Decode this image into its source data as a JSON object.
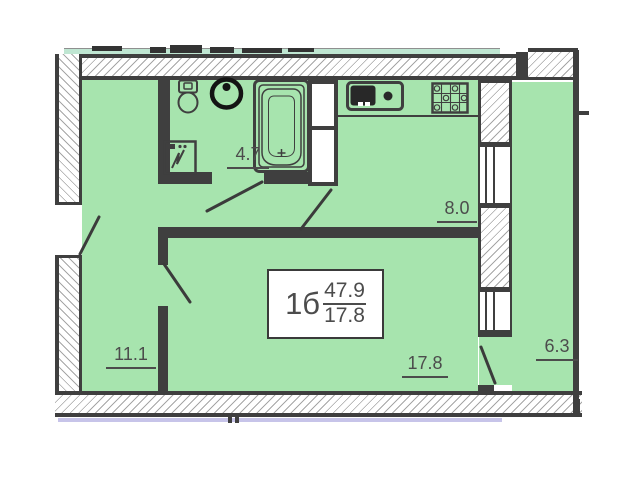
{
  "plan": {
    "info_box": {
      "type_label": "1б",
      "total_area": "47.9",
      "living_area": "17.8"
    },
    "rooms": [
      {
        "name": "bathroom",
        "area": "4.7"
      },
      {
        "name": "kitchen",
        "area": "8.0"
      },
      {
        "name": "hallway",
        "area": "11.1"
      },
      {
        "name": "living-room",
        "area": "17.8"
      },
      {
        "name": "balcony",
        "area": "6.3"
      }
    ],
    "colors": {
      "floor": "#a7e4ae",
      "strip": "#bfe6d2",
      "wall": "#3f3f3f",
      "hatch": "#a6a6a6",
      "lavender": "#c7c4e9",
      "label": "#4c4c4c",
      "fixture": "#1a1a1a"
    }
  }
}
